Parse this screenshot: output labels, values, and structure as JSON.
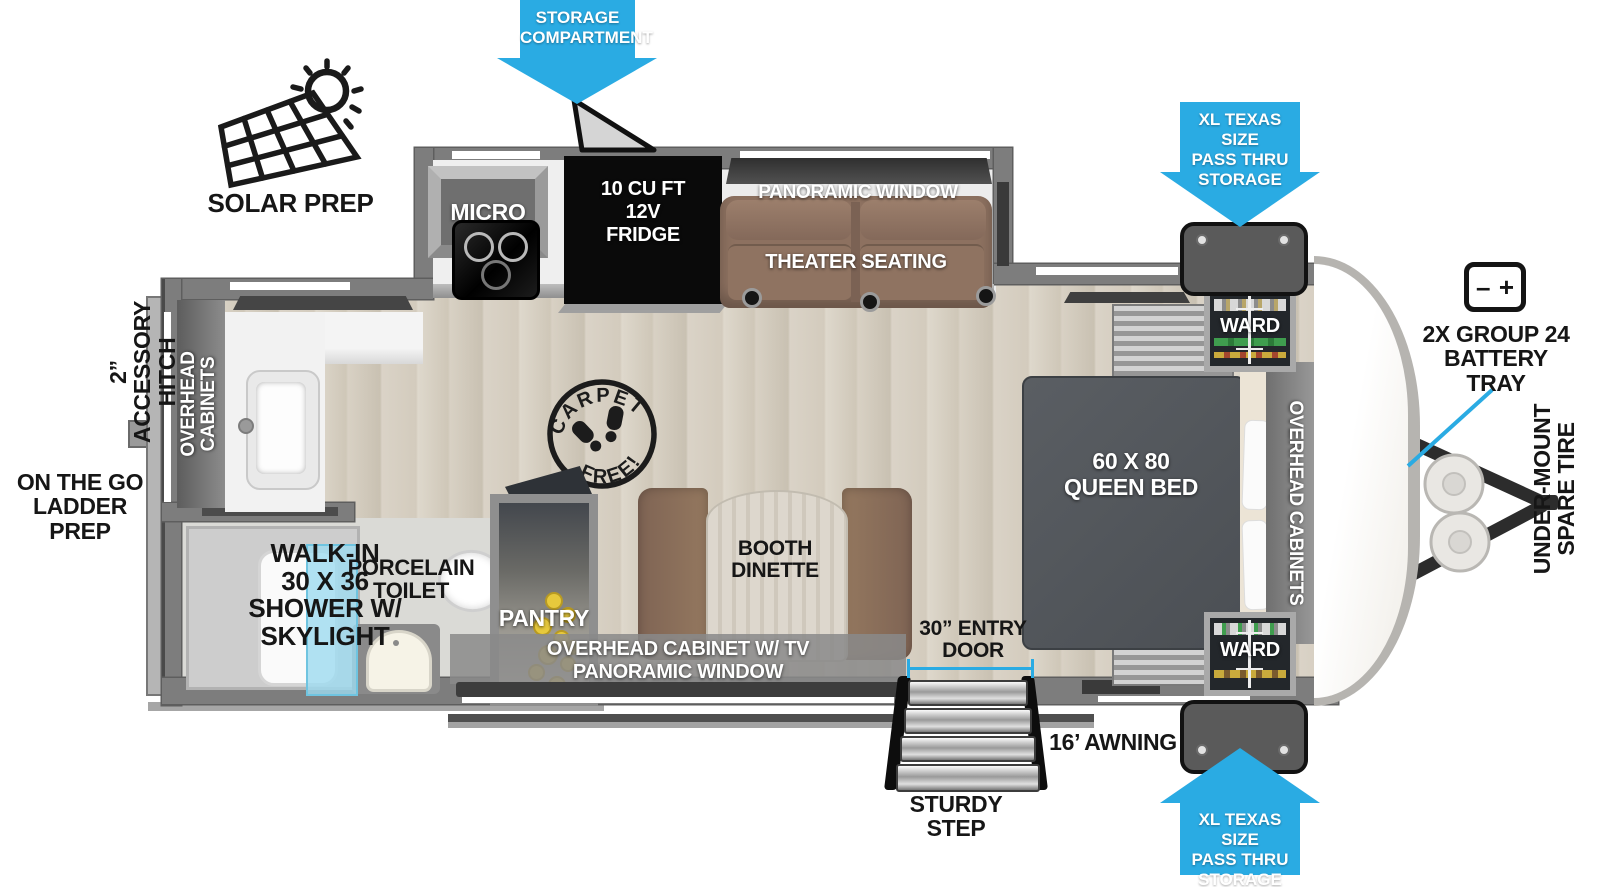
{
  "colors": {
    "arrow_blue": "#2aabe3",
    "wall_gray": "#7d7d7d",
    "floor_wood": "#d8d1c5",
    "seating_brown": "#8d7160",
    "shower_glass": "#9fdef0",
    "can_yellow": "#e7c93c",
    "appliance_black": "#111111"
  },
  "callouts": {
    "solar_prep": "SOLAR PREP",
    "storage_compartment": "STORAGE\nCOMPARTMENT",
    "pass_thru_top": "XL TEXAS SIZE\nPASS THRU\nSTORAGE",
    "pass_thru_bottom": "XL TEXAS SIZE\nPASS THRU\nSTORAGE",
    "battery_tray": "2X GROUP 24\nBATTERY\nTRAY",
    "battery_minus": "–",
    "battery_plus": "+",
    "spare_tire": "UNDER-MOUNT\nSPARE TIRE",
    "accessory_hitch": "2” ACCESSORY\nHITCH",
    "ladder_prep": "ON THE GO\nLADDER PREP",
    "awning": "16’ AWNING",
    "sturdy_step": "STURDY\nSTEP",
    "entry_door": "30” ENTRY\nDOOR"
  },
  "rooms": {
    "micro": "MICRO",
    "fridge": "10 CU FT\n12V\nFRIDGE",
    "panoramic_window_top": "PANORAMIC WINDOW",
    "theater_seating": "THEATER SEATING",
    "ward_top": "WARD",
    "ward_bottom": "WARD",
    "queen_bed": "60 X  80\nQUEEN BED",
    "overhead_cabinets_bedroom": "OVERHEAD CABINETS",
    "overhead_cabinets_rear": "OVERHEAD\nCABINETS",
    "booth_dinette": "BOOTH\nDINETTE",
    "pantry": "PANTRY",
    "tv_cabinet": "OVERHEAD CABINET W/ TV\nPANORAMIC WINDOW",
    "porcelain_toilet": "PORCELAIN\nTOILET",
    "shower": "WALK-IN\n30 X 36\nSHOWER W/\nSKYLIGHT",
    "carpet_free_top": "CARPET",
    "carpet_free_bottom": "FREE!"
  }
}
